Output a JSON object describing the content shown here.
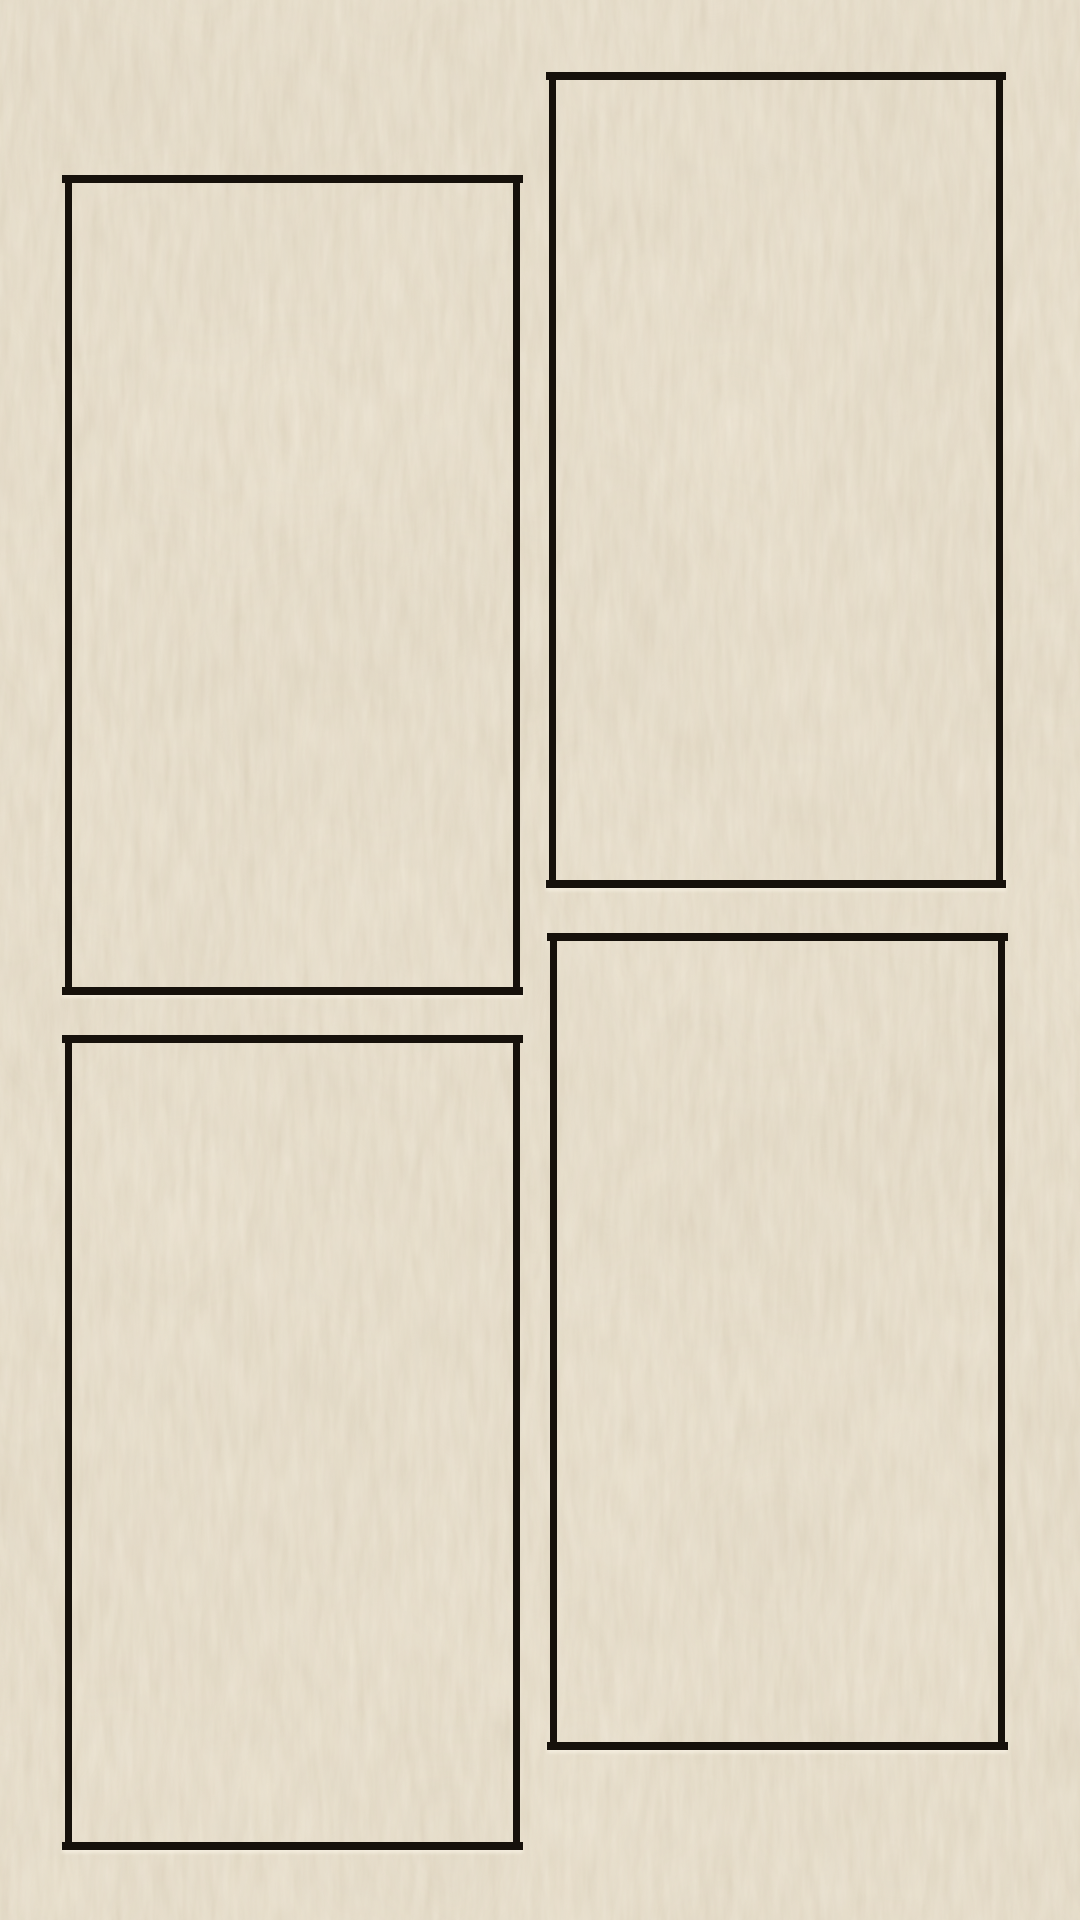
{
  "page": {
    "type": "blank four-panel comic page on textured cream paper",
    "visible_text": "",
    "colors": {
      "paper": "#e9e0cd",
      "ink": "#16110b",
      "grain_dark": "#d9cfb9",
      "grain_light": "#f3ebda"
    },
    "panels": [
      {
        "id": "top-left",
        "content": ""
      },
      {
        "id": "top-right",
        "content": ""
      },
      {
        "id": "bottom-left",
        "content": ""
      },
      {
        "id": "bottom-right",
        "content": ""
      }
    ]
  }
}
